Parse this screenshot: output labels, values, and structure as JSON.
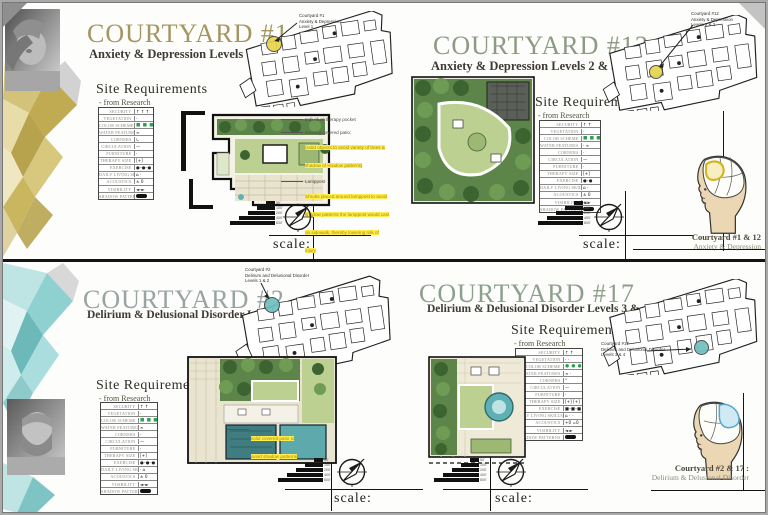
{
  "board_name": "Courtyard Design Presentation Board",
  "site_req": {
    "heading": "Site Requirements",
    "subheading": "- from Research",
    "labels": [
      "SECURITY",
      "VEGETATION",
      "COLOR SCHEME",
      "WATER FEATURES",
      "CORNERS",
      "CIRCULATION",
      "FURNITURE",
      "THERAPY SIZE",
      "EXERCISE",
      "DAILY LIVING SKILLS",
      "ACOUSTICS",
      "VISIBILITY",
      "SHADOW PATTERNS"
    ]
  },
  "quadrants": [
    {
      "id": "courtyard-1",
      "title": "COURTYARD #1",
      "subtitle": "Anxiety & Depression Levels 1",
      "title_color": "#a39660",
      "highlight_color": "#e8d44a",
      "table_values": [
        "↑ ↑ ↑",
        "·",
        "■ ■ ■",
        "≈",
        "∟",
        "—",
        "·",
        "[+]",
        "●–●–●",
        "⌂ ·",
        "± 0",
        "◄–►",
        "pill"
      ],
      "callout_lines": [
        "Courtyard #1",
        "Anxiety & Depression",
        "Level 1"
      ],
      "annotations": [
        {
          "plain": "Individual therapy pocket",
          "highlight": ""
        },
        {
          "plain": "Existing covered patio:",
          "highlight": "(solid objects to avoid variety of trees & shadow of shadow patterns)"
        },
        {
          "plain": "Lamppost",
          "highlight": "Shrubs placed around lamppost to avoid shadow patterns the lamppost would cast on sidewalk, thereby lowering risk of injury"
        }
      ],
      "scale_label": "scale:",
      "scale_ticks": [
        "50'",
        "100'",
        "200'",
        "400'",
        "600'"
      ]
    },
    {
      "id": "courtyard-12",
      "title": "COURTYARD #12",
      "subtitle": "Anxiety & Depression Levels 2 & 3",
      "title_color": "#8d9b84",
      "highlight_color": "#e8d44a",
      "table_values": [
        "↑ ↑",
        "·",
        "■ ■ ■",
        "· ≈",
        "·",
        "—",
        "·",
        "[+]",
        "●–●",
        "⌂ ·",
        "± 0",
        "◄ ►",
        "pill"
      ],
      "callout_lines": [
        "Courtyard #12",
        "Anxiety & Depression",
        "Levels 2 & 3"
      ],
      "annotations": [],
      "scale_label": "scale:",
      "scale_ticks": [
        "50'",
        "100'",
        "200'",
        "400'",
        "600'"
      ]
    },
    {
      "id": "courtyard-2",
      "title": "COURTYARD #2",
      "subtitle": "Delirium & Delusional Disorder Levels 1 & 2",
      "title_color": "#98a3a3",
      "highlight_color": "#6fc0c0",
      "table_values": [
        "↑ ↑",
        "·",
        "■ ■ ■",
        "≈",
        "·",
        "—",
        "·",
        "[+]",
        "●–●–●",
        "· ⌂",
        "± 0",
        "◄–►",
        "pill"
      ],
      "callout_lines": [
        "Courtyard #2",
        "Delirium and Delusional Disorder",
        "Levels 1 & 2"
      ],
      "annotations": [
        {
          "plain": "",
          "highlight": "solid covered patio to avoid shadow patterns"
        }
      ],
      "scale_label": "scale:",
      "scale_ticks": [
        "50'",
        "100'",
        "200'",
        "400'",
        "600'"
      ]
    },
    {
      "id": "courtyard-17",
      "title": "COURTYARD #17",
      "subtitle": "Delirium & Delusional Disorder Levels 3 & 4",
      "title_color": "#8da08d",
      "highlight_color": "#6fc0c0",
      "table_values": [
        "↑ ↑",
        "· ·",
        "● ● ●",
        "≈ ·",
        "°",
        "—",
        "·",
        "[+] [+]",
        "■–■–■",
        "⌂ · ·",
        "+0 =0",
        "◄ ►",
        "pill"
      ],
      "callout_lines": [
        "Courtyard #17",
        "Delirium and Delusional Disorder",
        "Levels 3 & 4"
      ],
      "annotations": [],
      "scale_label": "scale:",
      "scale_ticks": [
        "50'",
        "100'",
        "200'",
        "400'",
        "600'"
      ]
    }
  ],
  "right_panel": {
    "top": {
      "caption_bold": "Courtyard #1 & 12",
      "caption_sub": "Anxiety & Depression",
      "highlight_color": "#e8d44a"
    },
    "bottom": {
      "caption_bold": "Courtyard #2 & 17 :",
      "caption_sub": "Delirium & Delusional Disorder",
      "highlight_color": "#9fd4e8"
    }
  },
  "colors": {
    "annotation_highlight": "#ffec4f",
    "color_scheme_swatch": "#2f9e4f",
    "vegetation_dark": "#3c6431",
    "vegetation_mid": "#6f9c55",
    "lawn": "#bcd191",
    "water": "#4f9ca0",
    "deco_top": "#cdbb6e",
    "deco_bottom": "#9ed6d6"
  }
}
